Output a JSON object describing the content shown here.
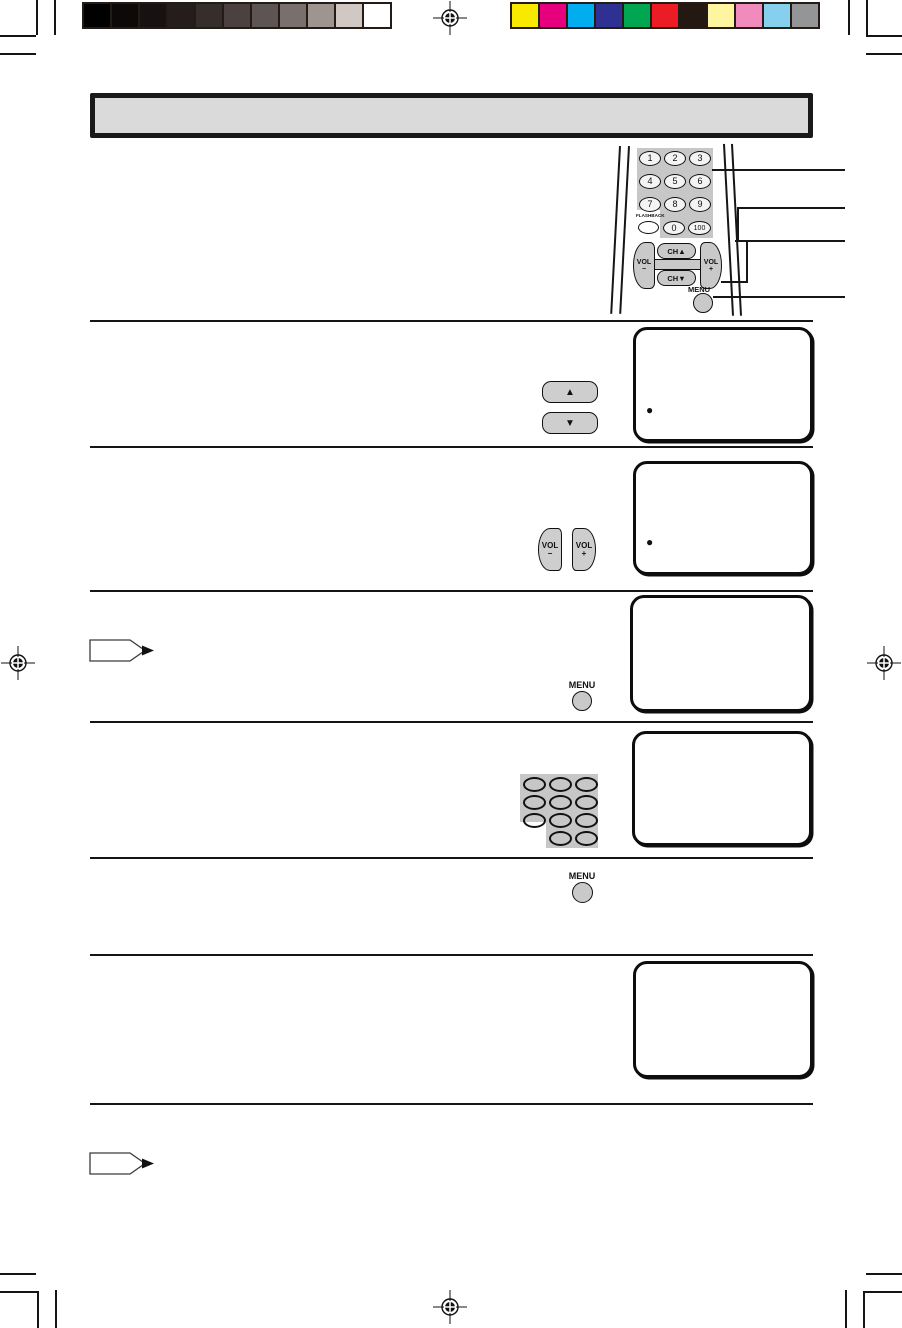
{
  "title_bar": {
    "text": ""
  },
  "print_bars": {
    "grayscale": [
      "#000000",
      "#0c0908",
      "#171211",
      "#241d1b",
      "#362e2c",
      "#4a4140",
      "#5d5553",
      "#796f6d",
      "#9f9590",
      "#d1c7c3",
      "#ffffff"
    ],
    "colors": [
      "#f9e800",
      "#e6007d",
      "#00aeef",
      "#2e3192",
      "#00a650",
      "#ec1c24",
      "#231812",
      "#fdf5a0",
      "#f18bbe",
      "#86cfee",
      "#939597"
    ]
  },
  "remote": {
    "digits": [
      "1",
      "2",
      "3",
      "4",
      "5",
      "6",
      "7",
      "8",
      "9"
    ],
    "zero": "0",
    "hundred": "100",
    "flashback_label": "FLASHBACK",
    "vol_label": "VOL",
    "minus_sign": "−",
    "plus_sign": "+",
    "ch_up_label": "CH▲",
    "ch_down_label": "CH▼",
    "menu_label": "MENU"
  },
  "steps": {
    "channel_buttons": {
      "up": "▲",
      "down": "▼"
    },
    "volume_buttons": {
      "vol": "VOL",
      "minus": "−",
      "plus": "+"
    },
    "menu_button_row3": "MENU",
    "menu_button_row5": "MENU",
    "display_bullet_1": "●",
    "display_bullet_2": "●"
  }
}
